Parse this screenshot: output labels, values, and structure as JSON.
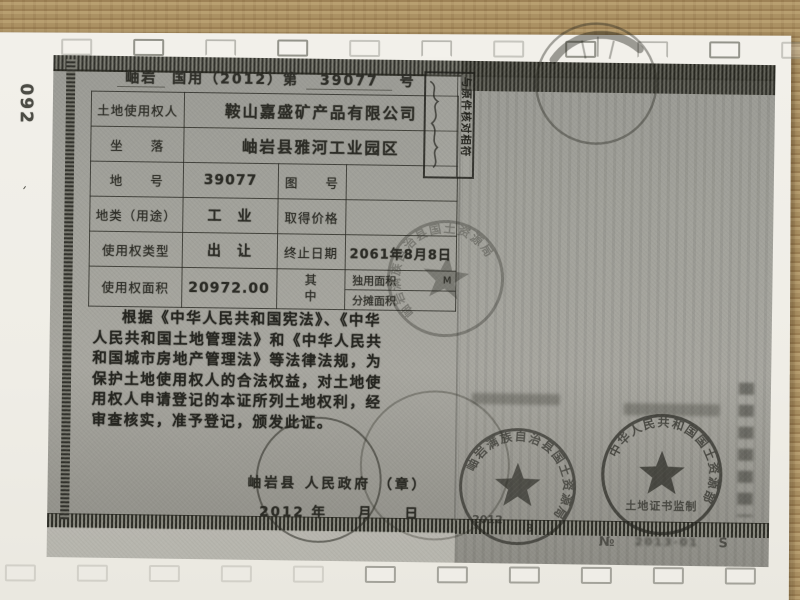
{
  "margin_note": "092",
  "certificate": {
    "header": {
      "region": "岫岩",
      "mid": "国用（2012）第",
      "number": "39077",
      "suffix": "号"
    },
    "table": {
      "rows": [
        {
          "label": "土地使用权人",
          "value": "鞍山嘉盛矿产品有限公司"
        },
        {
          "label": "坐　　落",
          "value": "岫岩县雅河工业园区"
        },
        {
          "label": "地　　号",
          "value": "39077",
          "label2": "图　　号",
          "value2": ""
        },
        {
          "label": "地类（用途）",
          "value": "工　业",
          "label2": "取得价格",
          "value2": ""
        },
        {
          "label": "使用权类型",
          "value": "出　让",
          "label2": "终止日期",
          "value2": "2061年8月8日"
        },
        {
          "label": "使用权面积",
          "value": "20972.00",
          "group_label": "其中",
          "sub_rows": [
            {
              "label": "独用面积",
              "value": "",
              "unit": "M"
            },
            {
              "label": "分摊面积",
              "value": "",
              "unit": ""
            }
          ]
        }
      ]
    },
    "body_text": {
      "lines": [
        "根据《中华人民共和国宪法》、《中华",
        "人民共和国土地管理法》和《中华人民共",
        "和国城市房地产管理法》等法律法规，为",
        "保护土地使用权人的合法权益，对土地使",
        "用权人申请登记的本证所列土地权利，经",
        "审查核实，准予登记，颁发此证。"
      ]
    },
    "issuer": {
      "county": "岫岩县",
      "authority": "人民政府",
      "seal_note": "（章）",
      "year": "2012",
      "date_units": "年　　月　　日"
    }
  },
  "stamps": {
    "verification": {
      "text": "与原件核对相符"
    },
    "county_land_bureau": {
      "ring_text": "岫岩满族自治县国土资源局",
      "date_year": "2012",
      "date_month": "3"
    },
    "ministry": {
      "ring_text": "中华人民共和国国土资源部",
      "caption": "土地证书监制",
      "serial_prefix": "№",
      "serial_digits": "2013·01",
      "serial_mark": "S"
    }
  }
}
